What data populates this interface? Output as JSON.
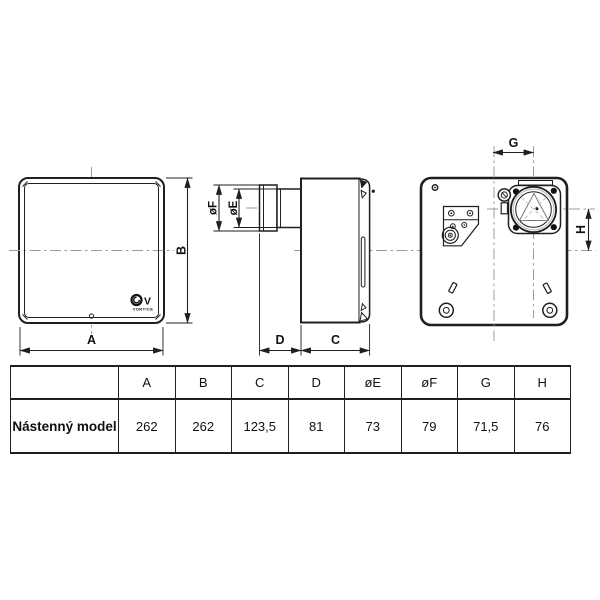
{
  "drawing": {
    "front_view": {
      "label_width": "A",
      "label_height": "B",
      "logo": {
        "mark": "V",
        "brand": "VORTICE"
      }
    },
    "side_view": {
      "label_duct_outer_dia": "øF",
      "label_duct_inner_dia": "øE",
      "label_duct_depth": "D",
      "label_body_depth": "C"
    },
    "back_view": {
      "label_horizontal_offset": "G",
      "label_vertical_offset": "H"
    }
  },
  "table": {
    "headers": [
      "",
      "A",
      "B",
      "C",
      "D",
      "øE",
      "øF",
      "G",
      "H"
    ],
    "rows": [
      {
        "label": "Nástenný model",
        "values": [
          "262",
          "262",
          "123,5",
          "81",
          "73",
          "79",
          "71,5",
          "76"
        ]
      }
    ]
  },
  "colors": {
    "line": "#1f1f1f",
    "centerline": "#9c9c9c",
    "light_detail": "#c4c4c4",
    "background": "#ffffff"
  }
}
